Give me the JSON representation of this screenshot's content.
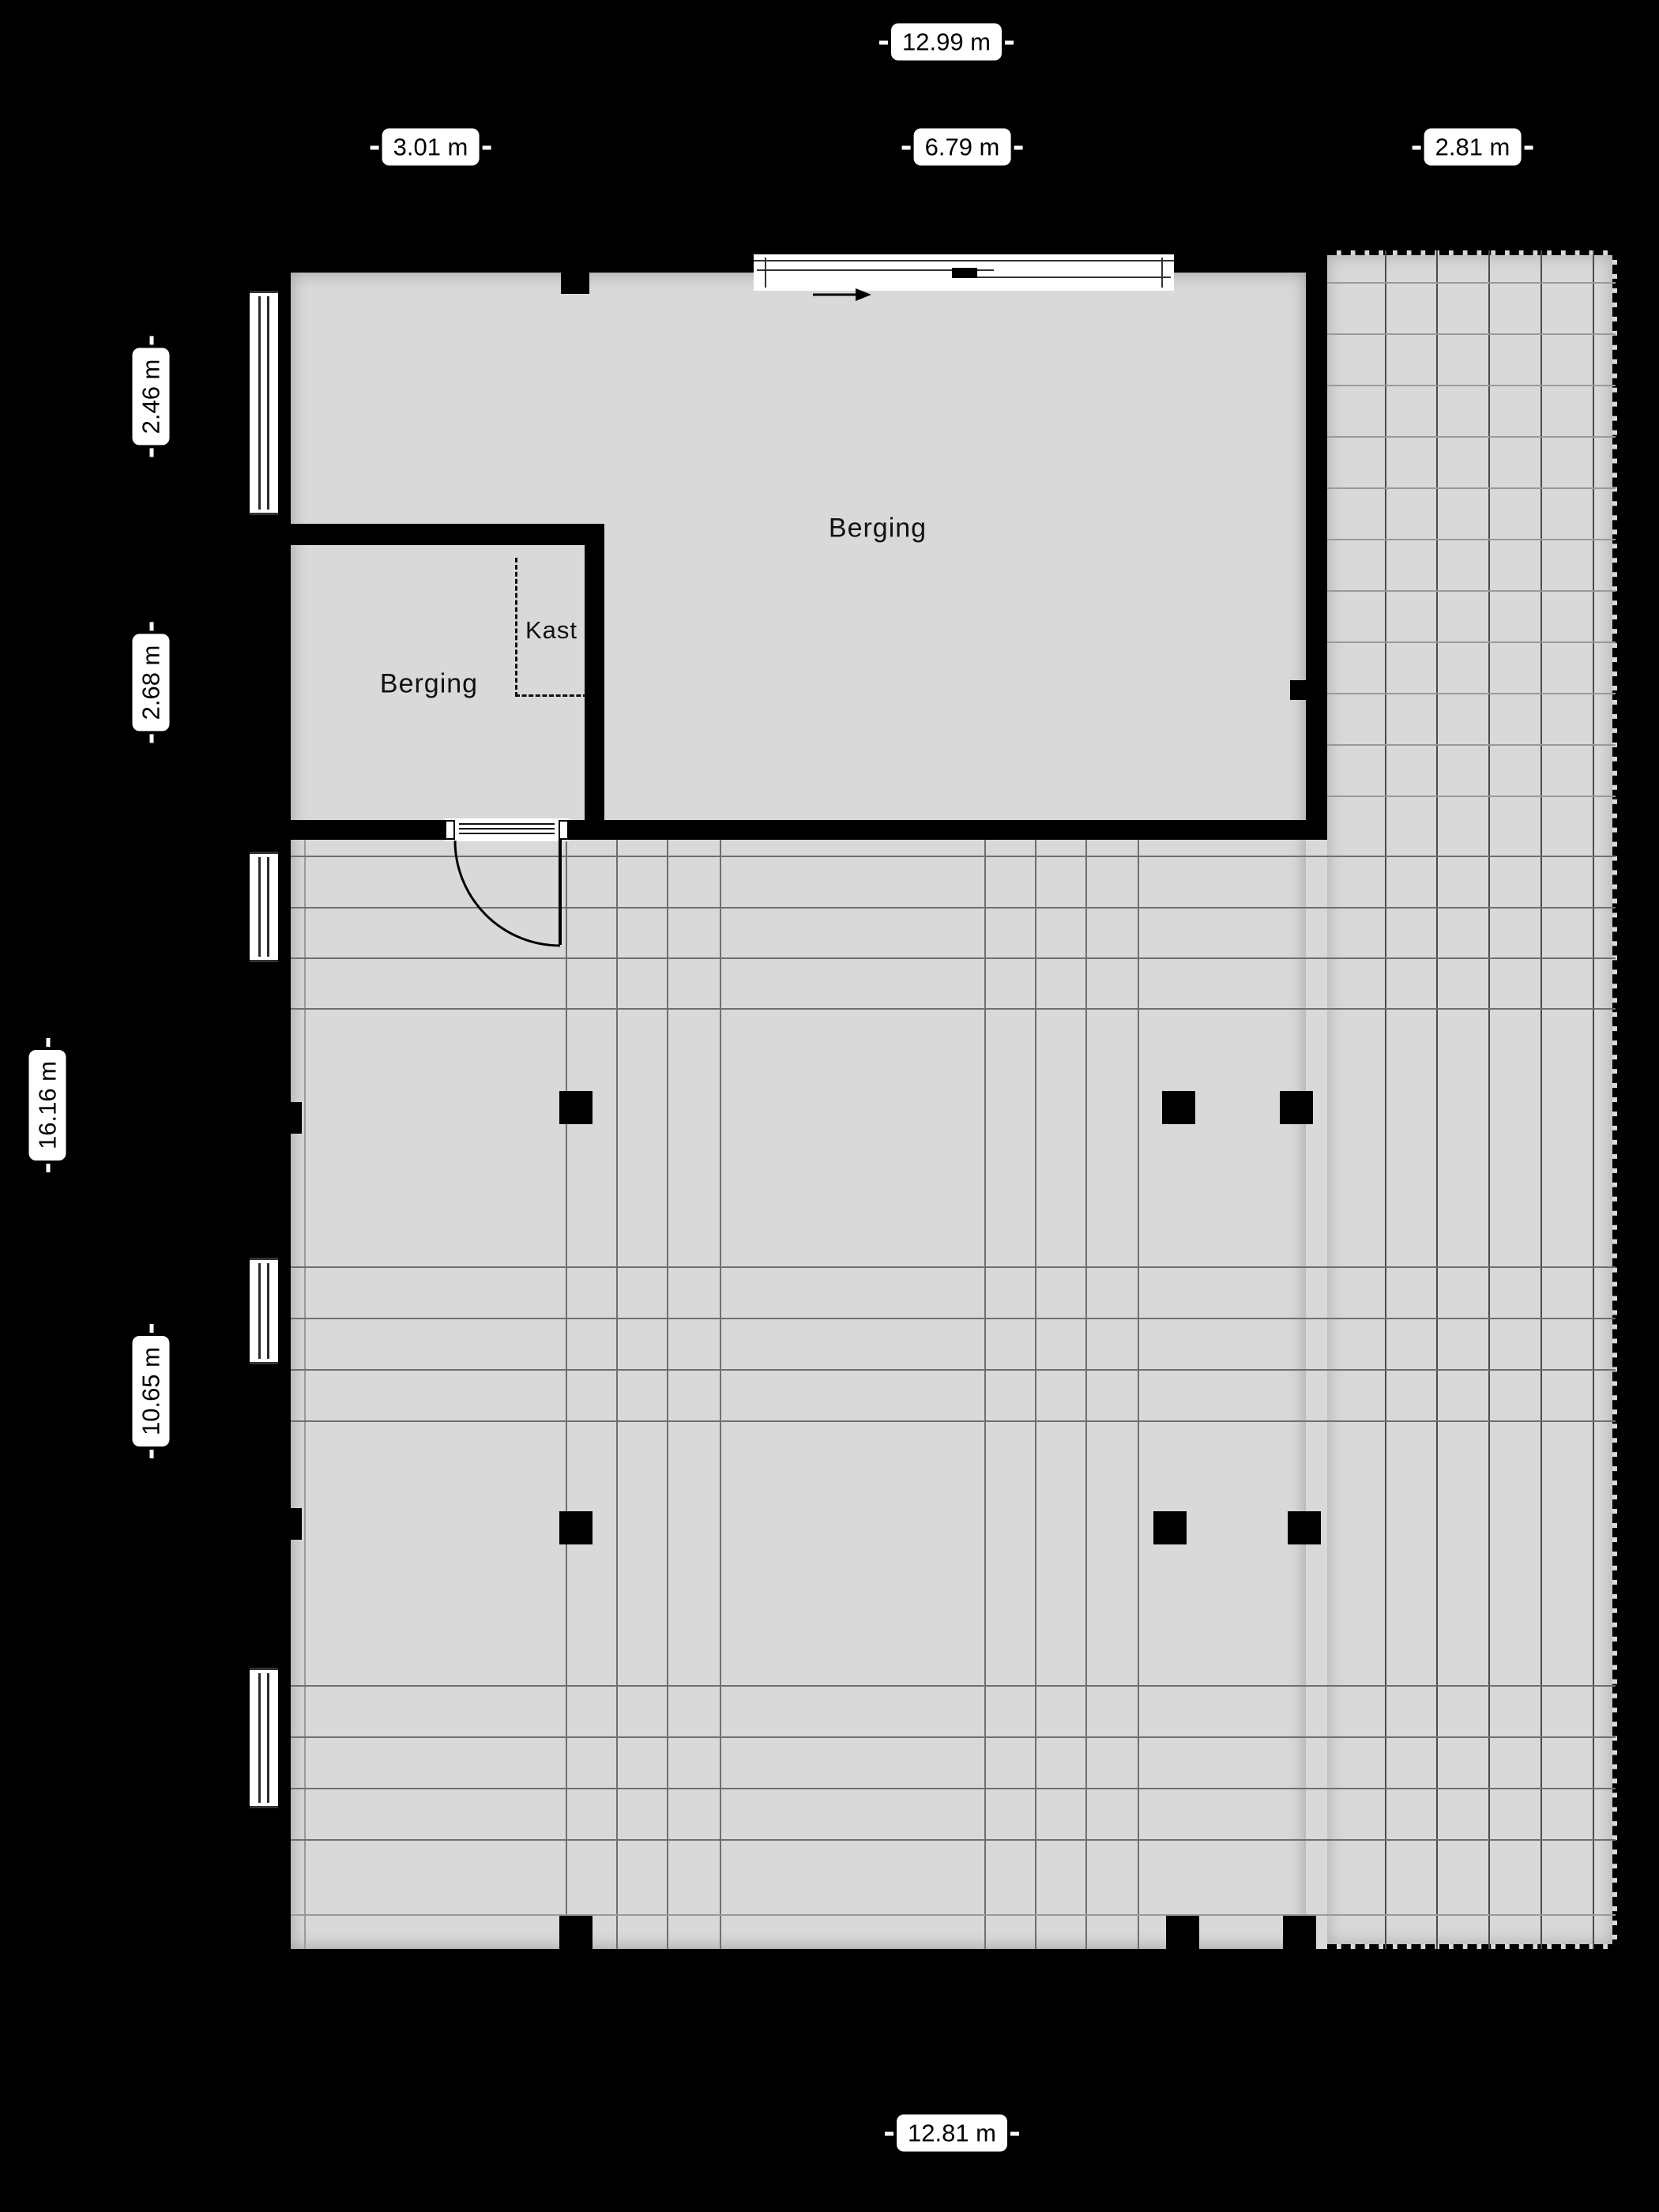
{
  "page": {
    "background": "#000000",
    "floor_color": "#d9d9d9",
    "wall_color": "#000000",
    "label_bg": "#ffffff",
    "label_text": "#000000",
    "grid_strong": "#4a4a4a",
    "grid_medium": "#6f6f6f",
    "grid_faint": "#9a9a9a"
  },
  "dimensions": {
    "top_total": "12.99 m",
    "top_left": "3.01 m",
    "top_mid": "6.79 m",
    "top_right": "2.81 m",
    "left_upper": "2.46 m",
    "left_mid": "2.68 m",
    "left_total": "16.16 m",
    "left_lower": "10.65 m",
    "bottom_total": "12.81 m"
  },
  "rooms": {
    "storage_large": "Berging",
    "storage_small": "Berging",
    "closet": "Kast"
  }
}
